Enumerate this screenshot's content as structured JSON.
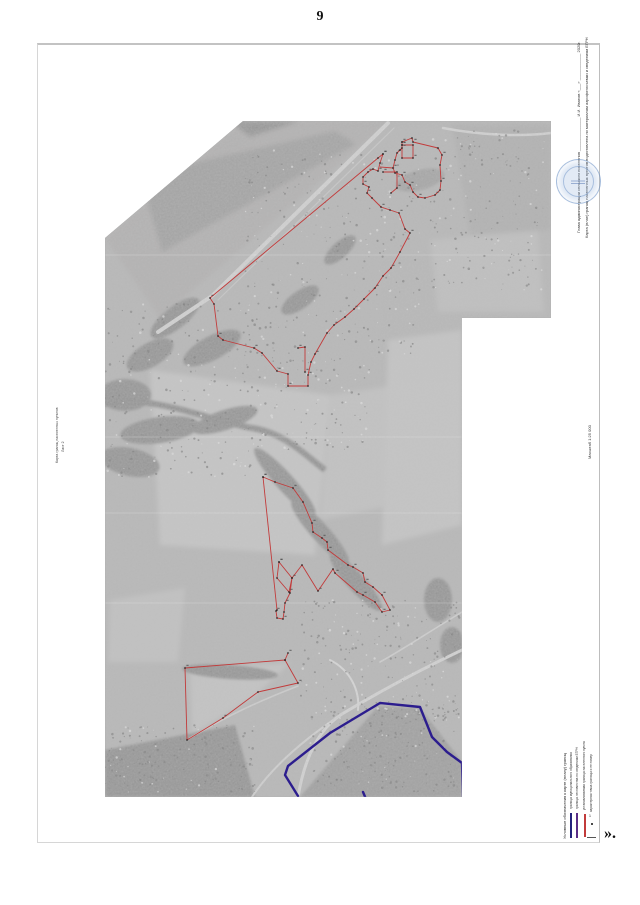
{
  "page": {
    "number": "9",
    "trailing_mark": "»."
  },
  "approval_block": {
    "line1": "Глава администрации сельского поселения _______________ И.И. Иванов   «___» ____________ 2020г.",
    "line2": "Карта (план) границ населенных пунктов подготовлена по материалам аэрофотосъемки и сведениям ЕГРН"
  },
  "side_notes": {
    "left_line1": "Карта границ населенных пунктов",
    "left_line2": "Лист 2",
    "scale": "Масштаб 1:25 000"
  },
  "legend": {
    "title": "Условные обозначения к карте (плану) границ",
    "entries": [
      {
        "label": "граница муниципального образования",
        "color": "#23237c"
      },
      {
        "label": "граница лесничества по сведениям ЕГРН",
        "color": "#5a2d86"
      },
      {
        "label": "устанавливаемая граница населенного пункта",
        "color": "#c23b3b"
      },
      {
        "label": "характерная точка границы и ее номер",
        "color": "#1a1a1a",
        "symbol": "1"
      }
    ]
  },
  "colors": {
    "boundary_red": "#c23b3b",
    "boundary_blue": "#2c1d8e",
    "stamp_blue": "#7d9fc7",
    "photo_base": "#b6b6b6"
  }
}
